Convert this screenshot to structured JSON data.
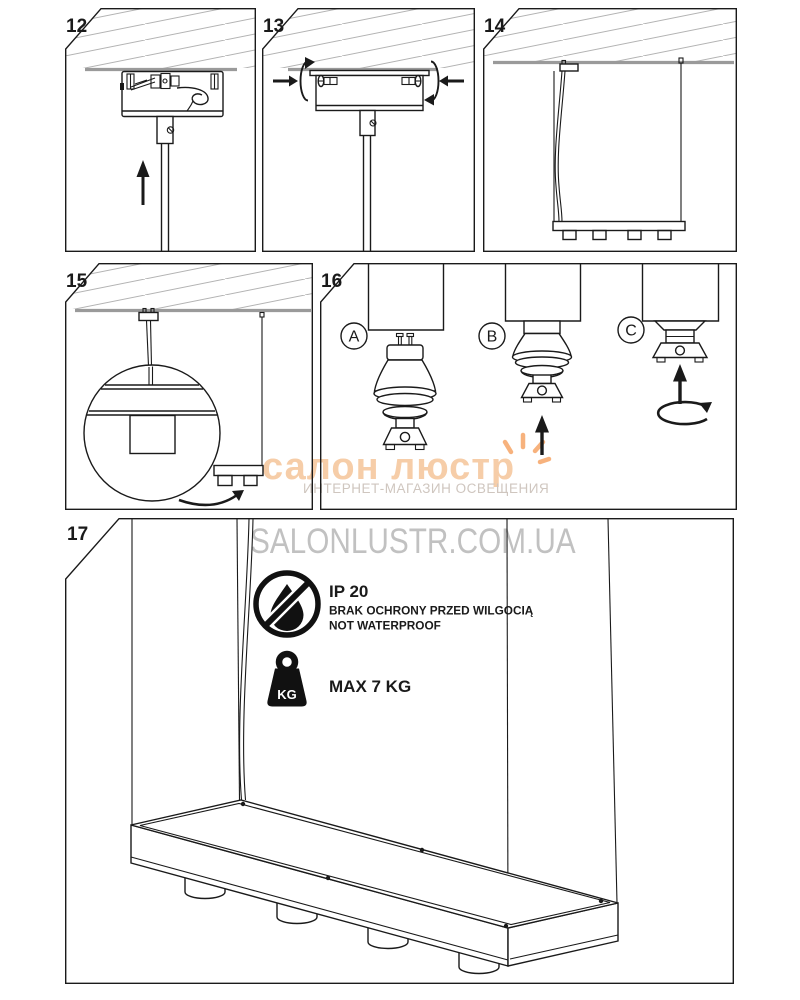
{
  "panels": {
    "p12": {
      "number": "12"
    },
    "p13": {
      "number": "13"
    },
    "p14": {
      "number": "14"
    },
    "p15": {
      "number": "15"
    },
    "p16": {
      "number": "16",
      "label_a": "A",
      "label_b": "B",
      "label_c": "C"
    },
    "p17": {
      "number": "17"
    }
  },
  "info": {
    "ip_rating": "IP 20",
    "ip_line1": "BRAK OCHRONY PRZED WILGOCIĄ",
    "ip_line2": "NOT WATERPROOF",
    "kg_label": "KG",
    "max_weight": "MAX 7 KG"
  },
  "watermark": {
    "brand": "салон люстр",
    "subtitle": "ИНТЕРНЕТ-МАГАЗИН ОСВЕЩЕНИЯ",
    "domain": "SALONLUSTR.COM.UA",
    "brand_color": "#f6cba4",
    "subtitle_color": "#cfc6bf",
    "domain_color": "#b7b7b7",
    "sparkle_color": "#f7b27d"
  },
  "colors": {
    "line": "#1a1a1a",
    "ceiling_line": "#9a9a9a",
    "hatch": "#b3b3b3",
    "background": "#ffffff"
  }
}
